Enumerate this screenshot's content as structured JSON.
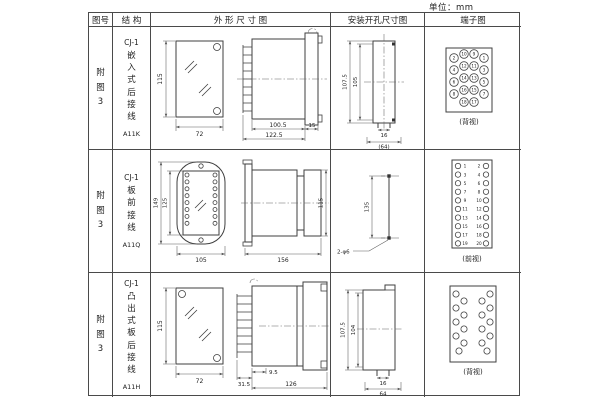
{
  "unit_label": "单位：mm",
  "headers": {
    "fig": "图号",
    "structure": "结 构",
    "outline": "外 形 尺 寸 图",
    "mounting": "安装开孔尺寸图",
    "terminal": "端子图"
  },
  "rows": [
    {
      "fig": "附图3",
      "model": "CJ-1",
      "type": "嵌入式后接线",
      "code": "A11K",
      "outline": {
        "front_h": "115",
        "front_w": "72",
        "d1": "100.5",
        "d2": "122.5",
        "d3": "15"
      },
      "mounting": {
        "v1": "107.5",
        "v2": "105",
        "h1": "16",
        "h2": "(64)"
      },
      "terminal": {
        "view": "(背视)",
        "groups": [
          [
            2,
            4,
            6,
            8
          ],
          [
            10,
            12,
            14,
            16,
            18
          ],
          [
            9,
            11,
            13,
            15,
            17
          ],
          [
            1,
            3,
            5,
            7
          ]
        ]
      }
    },
    {
      "fig": "附图3",
      "model": "CJ-1",
      "type": "板前接线",
      "code": "A11Q",
      "outline": {
        "v1": "149",
        "v2": "125",
        "w": "105",
        "d1": "156",
        "side_h": "115"
      },
      "mounting": {
        "v1": "135",
        "hole": "2-φ6"
      },
      "terminal": {
        "view": "(前视)",
        "groups": [
          [
            1,
            3,
            5,
            7,
            9,
            11,
            13,
            15,
            17,
            19
          ],
          [
            2,
            4,
            6,
            8,
            10,
            12,
            14,
            16,
            18,
            20
          ]
        ]
      }
    },
    {
      "fig": "附图3",
      "model": "CJ-1",
      "type": "凸出式板后接线",
      "code": "A11H",
      "outline": {
        "front_h": "115",
        "front_w": "72",
        "d1": "9.5",
        "d2": "31.5",
        "d3": "126"
      },
      "mounting": {
        "v1": "107.5",
        "v2": "104",
        "h1": "16",
        "h2": "64"
      },
      "terminal": {
        "view": "(背视)"
      }
    }
  ]
}
